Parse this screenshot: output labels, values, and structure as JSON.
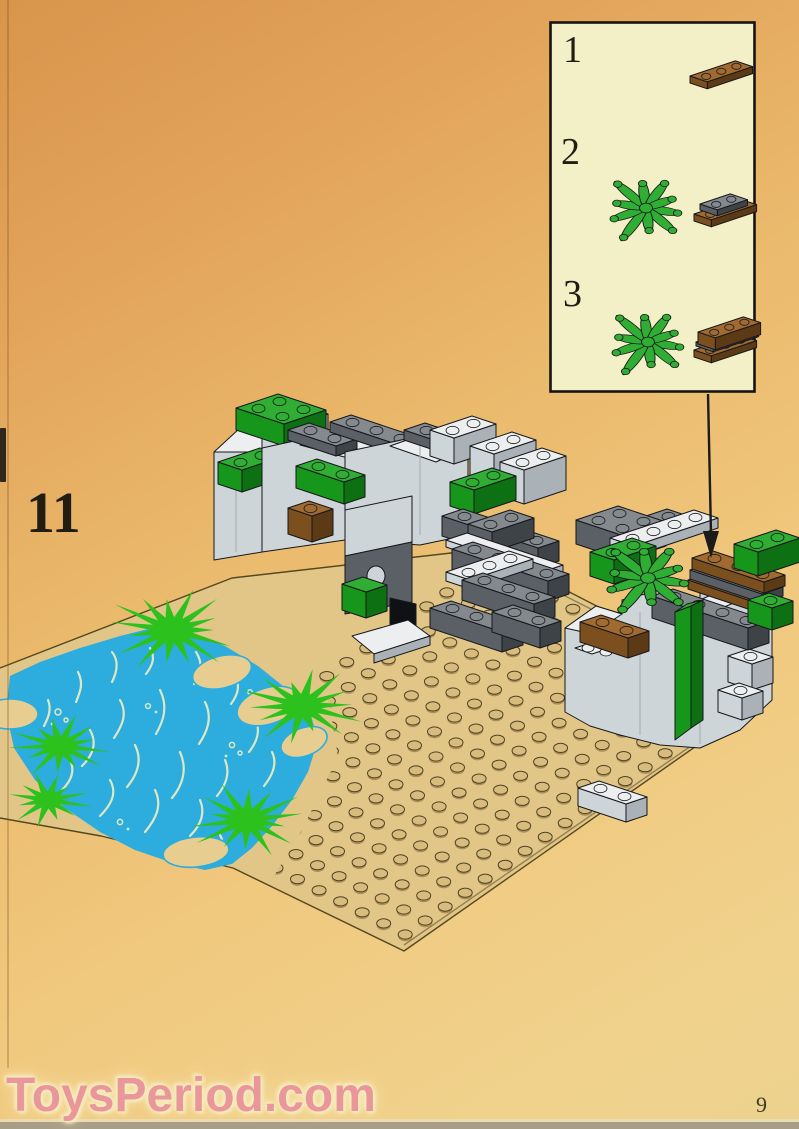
{
  "page": {
    "step_number": "11",
    "page_number": "9"
  },
  "watermark": {
    "text": "ToysPeriod.com"
  },
  "inset_box": {
    "steps": [
      {
        "label": "1",
        "part": "brown-plate-1x3"
      },
      {
        "label": "2",
        "part": "green-foliage-on-brown-plate-with-dark-gray-plate"
      },
      {
        "label": "3",
        "part": "green-foliage-with-brown-brick-on-brown-plate"
      }
    ]
  },
  "scene": {
    "elements": [
      "baseplate-with-studs",
      "pond",
      "grass-tufts",
      "sand-patches",
      "left-rock-formation",
      "right-rock-formation",
      "foliage-assembly",
      "callout-arrow",
      "loose-light-gray-brick"
    ]
  },
  "colors": {
    "baseplate": "#e2c687",
    "sand_patch": "#e8cd90",
    "stud": "#d8bc7d",
    "stud_outline": "#4e4224",
    "stud_shadow": "#aa9058",
    "plate_edge": "#55481f",
    "water": "#2cadde",
    "wave": "#dde8c2",
    "grass": "#2cc11d",
    "lego_green_top": "#2fae33",
    "lego_green_front": "#17961c",
    "lego_green_side": "#0d7012",
    "light_gray_top": "#eceeef",
    "light_gray_front": "#ced5d8",
    "light_gray_side": "#aab2b7",
    "dark_gray_top": "#84898e",
    "dark_gray_front": "#5a6065",
    "dark_gray_side": "#3e4348",
    "brown_top": "#a06a31",
    "brown_front": "#7c4f1f",
    "brown_side": "#5c3a15",
    "outline": "#16181b",
    "box_bg": "#f3efc7",
    "box_border": "#141414",
    "arrow": "#1b1b1b",
    "number": "#221d13",
    "watermark_text": "#e9959d",
    "watermark_glow": "#f6edc1"
  }
}
